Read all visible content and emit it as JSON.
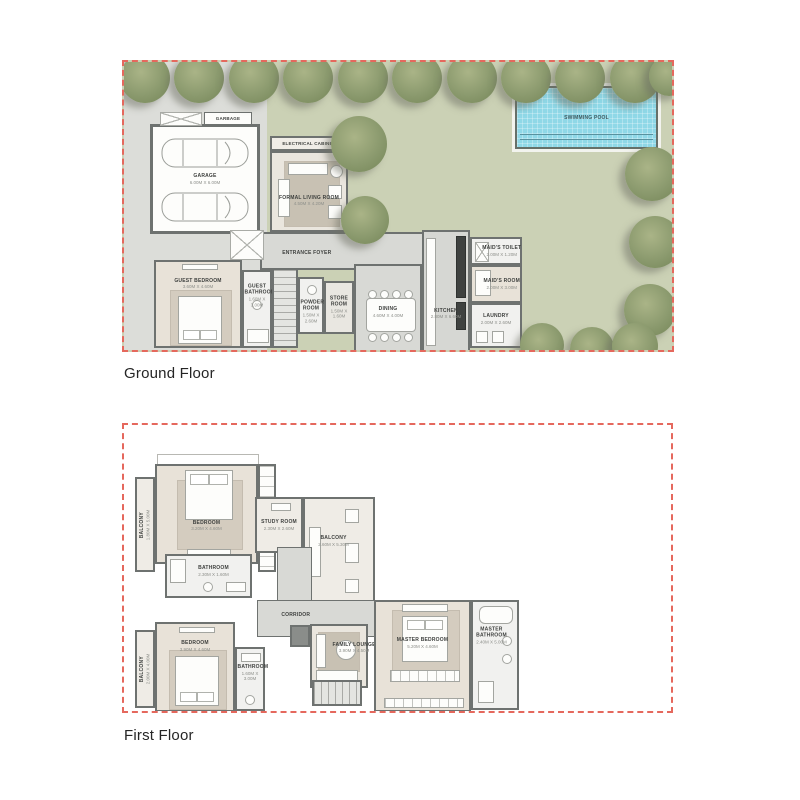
{
  "page": {
    "background": "#ffffff"
  },
  "colors": {
    "boundary_dash": "#e5685d",
    "garden": "#cbd1b5",
    "driveway": "#dcddd9",
    "wall": "#6e7270",
    "floor_beige": "#eae6de",
    "carpet": "#e8e2d8",
    "concrete": "#d8d9d5",
    "pool_water": "#8fd8e7",
    "tree": "#8b9a6e",
    "caption_text": "#252525"
  },
  "ground_floor": {
    "caption": "Ground Floor",
    "pool_label": "SWIMMING POOL",
    "rooms": {
      "garbage": {
        "name": "GARBAGE"
      },
      "garage": {
        "name": "GARAGE",
        "dims": "6.00M X 6.00M"
      },
      "electrical_cabinet": {
        "name": "ELECTRICAL CABINET"
      },
      "formal_living_room": {
        "name": "FORMAL LIVING ROOM",
        "dims": "4.50M X 4.20M"
      },
      "entrance_foyer": {
        "name": "ENTRANCE FOYER"
      },
      "guest_bedroom": {
        "name": "GUEST BEDROOM",
        "dims": "3.60M X 4.60M"
      },
      "guest_bathroom": {
        "name": "GUEST BATHROOM",
        "dims": "1.60M X 3.00M"
      },
      "powder_room": {
        "name": "POWDER ROOM",
        "dims": "1.50M X 2.60M"
      },
      "store_room": {
        "name": "STORE ROOM",
        "dims": "1.50M X 1.60M"
      },
      "dining": {
        "name": "DINING",
        "dims": "4.60M X 4.00M"
      },
      "kitchen": {
        "name": "KITCHEN",
        "dims": "2.80M X 6.60M"
      },
      "maids_toilet": {
        "name": "MAID'S TOILET",
        "dims": "2.00M X 1.20M"
      },
      "maids_room": {
        "name": "MAID'S ROOM",
        "dims": "2.00M X 3.00M"
      },
      "laundry": {
        "name": "LAUNDRY",
        "dims": "2.00M X 2.60M"
      }
    }
  },
  "first_floor": {
    "caption": "First Floor",
    "rooms": {
      "balcony_top": {
        "name": "BALCONY",
        "dims": "1.80M X 5.00M"
      },
      "bedroom_top": {
        "name": "BEDROOM",
        "dims": "3.20M X 4.60M"
      },
      "bathroom_top": {
        "name": "BATHROOM",
        "dims": "2.30M X 1.60M"
      },
      "study_room": {
        "name": "STUDY ROOM",
        "dims": "2.30M X 2.60M"
      },
      "balcony_right": {
        "name": "BALCONY",
        "dims": "2.60M X 5.30M"
      },
      "corridor": {
        "name": "CORRIDOR"
      },
      "bedroom_bottom": {
        "name": "BEDROOM",
        "dims": "3.90M X 4.60M"
      },
      "balcony_bottom": {
        "name": "BALCONY",
        "dims": "2.00M X 4.00M"
      },
      "bathroom_bottom": {
        "name": "BATHROOM",
        "dims": "1.60M X 3.00M"
      },
      "family_lounge": {
        "name": "FAMILY LOUNGE",
        "dims": "3.90M X 4.50M"
      },
      "master_bedroom": {
        "name": "MASTER BEDROOM",
        "dims": "5.20M X 4.60M"
      },
      "master_bathroom": {
        "name": "MASTER BATHROOM",
        "dims": "2.40M X 5.00M"
      }
    }
  }
}
